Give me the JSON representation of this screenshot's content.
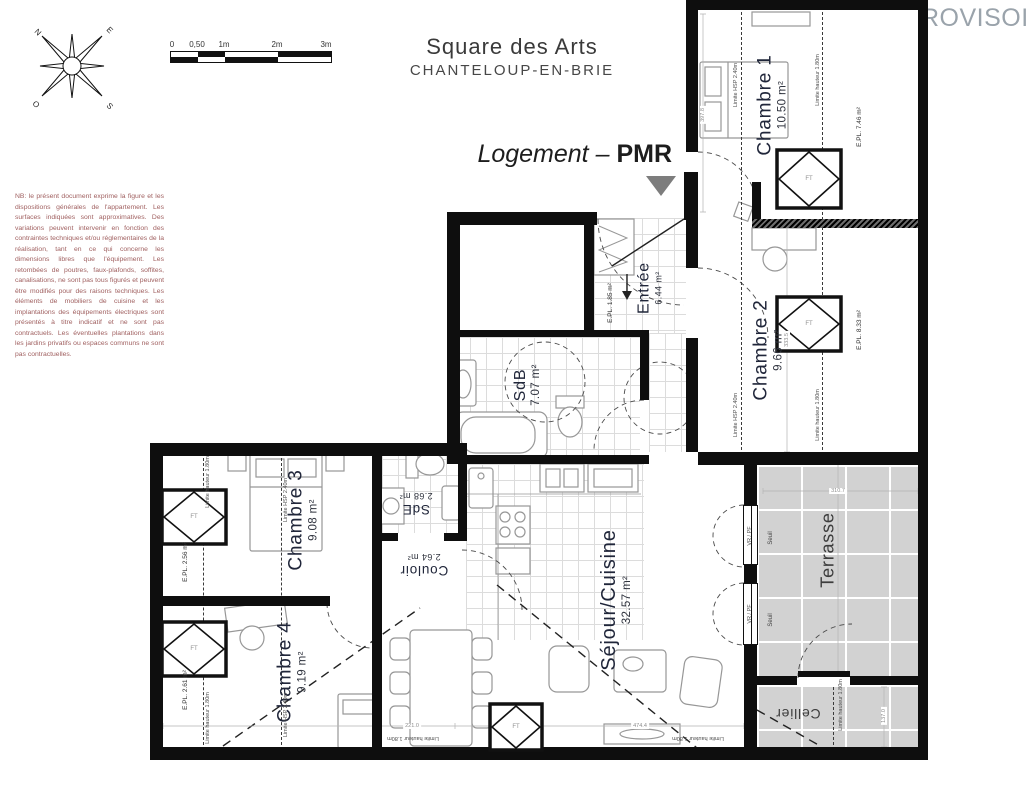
{
  "header": {
    "title": "Square des Arts",
    "subtitle": "CHANTELOUP-EN-BRIE",
    "unit_type_italic": "Logement –",
    "unit_type_bold": "PMR",
    "watermark": "ROVISOIRE"
  },
  "compass": {
    "n": "N",
    "e": "E",
    "s": "S",
    "o": "O"
  },
  "scalebar": {
    "labels": [
      "0",
      "0,50",
      "1m",
      "2m",
      "3m"
    ]
  },
  "note": "NB: le présent document exprime la figure et les dispositions générales de l'appartement. Les surfaces indiquées sont approximatives. Des variations peuvent intervenir en fonction des contraintes techniques et/ou réglementaires de la réalisation, tant en ce qui concerne les dimensions libres que l'équipement. Les retombées de poutres, faux-plafonds, soffites, canalisations, ne sont pas tous figurés et peuvent être modifiés pour des raisons techniques. Les éléments de mobiliers de cuisine et les implantations des équipements électriques sont présentés à titre indicatif et ne sont pas contractuels. Les éventuelles plantations dans les jardins privatifs ou espaces communs ne sont pas contractuelles.",
  "rooms": [
    {
      "name": "Chambre 1",
      "area": "10.50 m²"
    },
    {
      "name": "Chambre 2",
      "area": "9.66 m²"
    },
    {
      "name": "Entrée",
      "area": "6.44 m²"
    },
    {
      "name": "SdB",
      "area": "7.07 m²"
    },
    {
      "name": "SdE",
      "area": "2.68 m²"
    },
    {
      "name": "Couloir",
      "area": "2.64 m²"
    },
    {
      "name": "Chambre 3",
      "area": "9.08 m²"
    },
    {
      "name": "Chambre 4",
      "area": "9.19 m²"
    },
    {
      "name": "Séjour/Cuisine",
      "area": "32.57 m²"
    },
    {
      "name": "Terrasse",
      "area": ""
    },
    {
      "name": "Cellier",
      "area": ""
    }
  ],
  "annotations": {
    "epl": [
      "E.PL. 7.46 m²",
      "E.PL. 8.33 m²",
      "E.PL. 1.85 m²",
      "E.PL. 2.56 m²",
      "E.PL. 2.61 m²"
    ],
    "limite_hsp": "Limite HSP 2.40m",
    "limite_hauteur": "Limite hauteur 1.80m",
    "window_ft": "FT",
    "window_vrpf": "VR / PF",
    "seuil": "Seuil"
  },
  "dimensions": [
    "397.8",
    "333.5",
    "310.7",
    "221.0",
    "474.4",
    "137.0"
  ],
  "colors": {
    "wall": "#0e0e0e",
    "terrace": "#d2d2d2",
    "note_text": "#a06060",
    "watermark": "#9aa3ab",
    "label": "#20263a"
  }
}
